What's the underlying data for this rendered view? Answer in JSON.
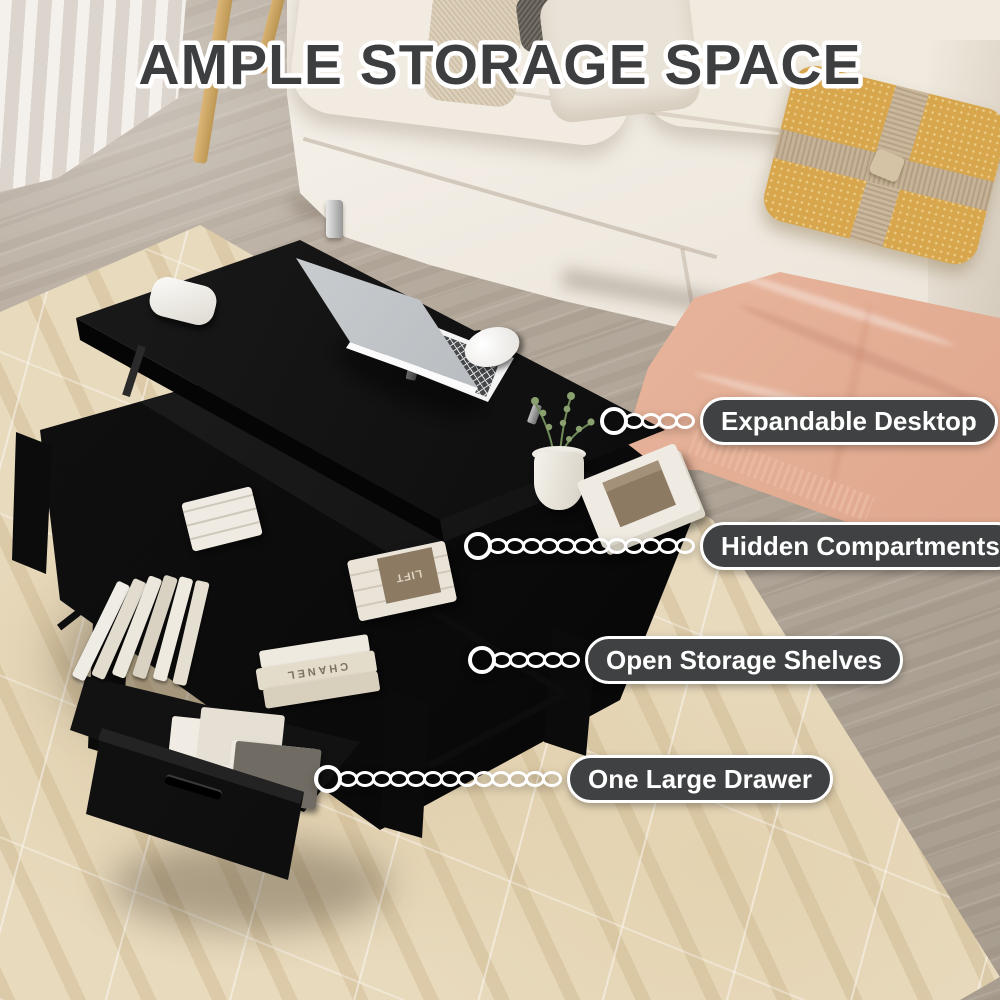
{
  "title": "AMPLE STORAGE SPACE",
  "callouts": [
    {
      "label": "Expandable Desktop",
      "links": 4
    },
    {
      "label": "Hidden Compartments",
      "links": 12
    },
    {
      "label": "Open Storage Shelves",
      "links": 5
    },
    {
      "label": "One Large Drawer",
      "links": 13
    }
  ],
  "props": {
    "book_spine": "CHANEL",
    "magazine_cover": "LIFT"
  },
  "colors": {
    "pill_bg": "#3f4142",
    "pill_border": "#ffffff",
    "pill_text": "#ffffff",
    "title_fill": "#3c3e40",
    "title_outline": "#ffffff",
    "table_black": "#101010",
    "rug_beige": "#e8dabd",
    "floor_wood": "#b2a79a",
    "sofa_cream": "#eee8dd",
    "blanket_peach": "#e8b49d",
    "pillow_mustard": "#d7a64d"
  }
}
